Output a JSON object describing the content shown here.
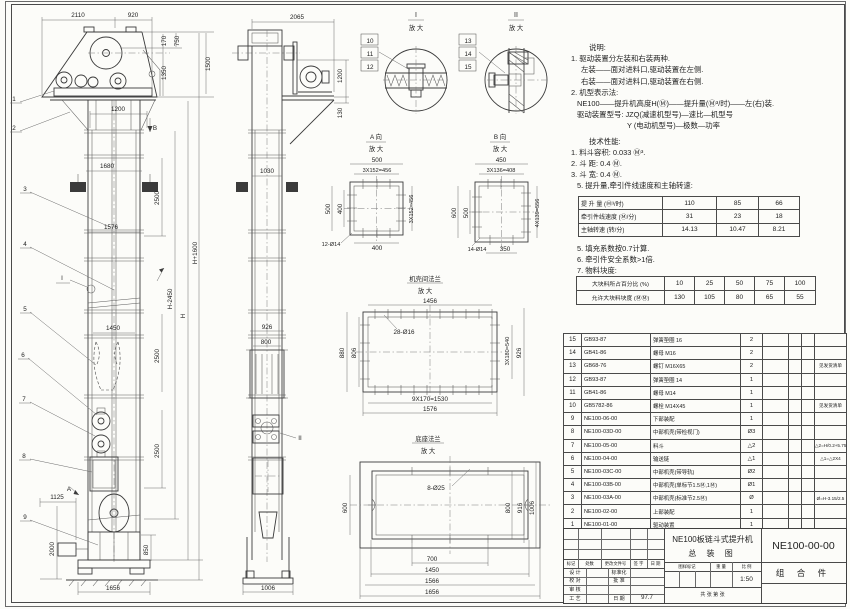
{
  "notes": {
    "lines": [
      {
        "t": "说明:",
        "ind": 26,
        "gap": 0
      },
      {
        "t": "1. 驱动装置分左装和右装两种.",
        "ind": 8,
        "gap": 0
      },
      {
        "t": "左装——面对进料口,驱动装置在左侧.",
        "ind": 18,
        "gap": 0
      },
      {
        "t": "右装——面对进料口,驱动装置在右侧.",
        "ind": 18,
        "gap": 0
      },
      {
        "t": "2. 机型表示法:",
        "ind": 8,
        "gap": 0
      },
      {
        "t": "NE100——提升机高度H(Ⓜ)——提升量(Ⓜ³/时)——左(右)装.",
        "ind": 14,
        "gap": 0
      },
      {
        "t": "驱动装置型号: JZQ(减速机型号)—速比—机型号",
        "ind": 14,
        "gap": 0
      },
      {
        "t": "Y (电动机型号)—极数—功率",
        "ind": 64,
        "gap": 0
      },
      {
        "t": "技术性能:",
        "ind": 26,
        "gap": 4
      },
      {
        "t": "1. 料斗容积: 0.033 Ⓜ³.",
        "ind": 8,
        "gap": 0
      },
      {
        "t": "2. 斗  距: 0.4 Ⓜ.",
        "ind": 8,
        "gap": 0
      },
      {
        "t": "3. 斗  宽: 0.4 Ⓜ.",
        "ind": 8,
        "gap": 0
      },
      {
        "t": "5. 提升量,牵引件线速度和主轴转速:",
        "ind": 14,
        "gap": 0
      }
    ]
  },
  "notes2": {
    "lines": [
      {
        "t": "5. 填充系数按0.7计算.",
        "ind": 14,
        "gap": 0
      },
      {
        "t": "6. 牵引件安全系数>1倍.",
        "ind": 14,
        "gap": 0
      },
      {
        "t": "7. 物料块度:",
        "ind": 14,
        "gap": 0
      }
    ]
  },
  "spec_table1": {
    "rows": [
      [
        "提 升 量  (Ⓜ³/时)",
        "110",
        "85",
        "66"
      ],
      [
        "牵引件线速度 (Ⓜ/分)",
        "31",
        "23",
        "18"
      ],
      [
        "主轴转速  (转/分)",
        "14.13",
        "10.47",
        "8.21"
      ]
    ]
  },
  "lump_table": {
    "rows": [
      [
        "大块料所占百分比 (%)",
        "10",
        "25",
        "50",
        "75",
        "100"
      ],
      [
        "允许大块料块度 (ⓂⓂ)",
        "130",
        "105",
        "80",
        "65",
        "55"
      ]
    ]
  },
  "bom": {
    "rows": [
      [
        "15",
        "GB93-87",
        "弹簧垫圈 16",
        "2",
        "",
        "",
        "",
        ""
      ],
      [
        "14",
        "GB41-86",
        "螺母 M16",
        "2",
        "",
        "",
        "",
        ""
      ],
      [
        "13",
        "GB68-76",
        "螺钉 M16X65",
        "2",
        "",
        "",
        "",
        "见发货清单"
      ],
      [
        "12",
        "GB93-87",
        "弹簧垫圈 14",
        "1",
        "",
        "",
        "",
        ""
      ],
      [
        "11",
        "GB41-86",
        "螺母 M14",
        "1",
        "",
        "",
        "",
        ""
      ],
      [
        "10",
        "GB5782-86",
        "螺栓 M14X45",
        "1",
        "",
        "",
        "",
        "见发货清单"
      ],
      [
        "9",
        "NE100-06-00",
        "下部装配",
        "1",
        "",
        "",
        "",
        ""
      ],
      [
        "8",
        "NE100-03D-00",
        "中部机壳(带检视门)",
        "Ø3",
        "",
        "",
        "",
        ""
      ],
      [
        "7",
        "NE100-05-00",
        "料斗",
        "△2",
        "",
        "",
        "",
        "△2=H/0.2+5.75"
      ],
      [
        "6",
        "NE100-04-00",
        "输送链",
        "△1",
        "",
        "",
        "",
        "△1=△2X4"
      ],
      [
        "5",
        "NE100-03C-00",
        "中部机壳(带导轨)",
        "Ø2",
        "",
        "",
        "",
        ""
      ],
      [
        "4",
        "NE100-03B-00",
        "中部机壳(单标节1.5Ⓜ,1Ⓜ)",
        "Ø1",
        "",
        "",
        "",
        ""
      ],
      [
        "3",
        "NE100-03A-00",
        "中部机壳(标准节2.5Ⓜ)",
        "Ø",
        "",
        "",
        "",
        "Ø=H-3.15/2.5"
      ],
      [
        "2",
        "NE100-02-00",
        "上部装配",
        "1",
        "",
        "",
        "",
        ""
      ],
      [
        "1",
        "NE100-01-00",
        "驱动装置",
        "1",
        "",
        "",
        "",
        ""
      ]
    ],
    "footer": [
      "序号",
      "代  号",
      "名      称",
      "数量",
      "材  料",
      "单重",
      "总重",
      "备  注"
    ]
  },
  "title_block": {
    "product": "NE100板链斗式提升机",
    "title": "总  装  图",
    "dno": "NE100-00-00",
    "part": "组 合 件",
    "scale": "1:50",
    "date": "97.7",
    "rev_headers": [
      "标记",
      "处数",
      "更改文件号",
      "签 字",
      "日 期"
    ],
    "col1": [
      "设 计",
      "校 对",
      "审 核",
      "工 艺"
    ],
    "col2": [
      "标准化",
      "批 准",
      "",
      "日 期"
    ],
    "stamp": [
      "图样标记",
      "重 量",
      "比 例"
    ],
    "pages": "共    张   第    张"
  },
  "drawing": {
    "labels": [
      {
        "t": "2110",
        "x": 78,
        "y": 17
      },
      {
        "t": "920",
        "x": 133,
        "y": 17
      },
      {
        "t": "170",
        "x": 166,
        "y": 41,
        "r": -90
      },
      {
        "t": "750",
        "x": 179,
        "y": 41,
        "r": -90
      },
      {
        "t": "1350",
        "x": 166,
        "y": 73,
        "r": -90
      },
      {
        "t": "1500",
        "x": 210,
        "y": 64,
        "r": -90
      },
      {
        "t": "1200",
        "x": 118,
        "y": 111
      },
      {
        "t": "B",
        "x": 155,
        "y": 130
      },
      {
        "t": "1680",
        "x": 107,
        "y": 168
      },
      {
        "t": "2500",
        "x": 159,
        "y": 198,
        "r": -90
      },
      {
        "t": "1576",
        "x": 111,
        "y": 229
      },
      {
        "t": "H+1600",
        "x": 197,
        "y": 253,
        "r": -90
      },
      {
        "t": "H-2450",
        "x": 172,
        "y": 299,
        "r": -90
      },
      {
        "t": "H",
        "x": 185,
        "y": 316,
        "r": -90
      },
      {
        "t": "1450",
        "x": 113,
        "y": 330
      },
      {
        "t": "2500",
        "x": 159,
        "y": 356,
        "r": -90
      },
      {
        "t": "2500",
        "x": 159,
        "y": 451,
        "r": -90
      },
      {
        "t": "1125",
        "x": 57,
        "y": 499
      },
      {
        "t": "2000",
        "x": 54,
        "y": 549,
        "r": -90
      },
      {
        "t": "850",
        "x": 148,
        "y": 550,
        "r": -90
      },
      {
        "t": "1656",
        "x": 113,
        "y": 590
      },
      {
        "t": "A",
        "x": 69,
        "y": 491
      },
      {
        "t": "I",
        "x": 62,
        "y": 280
      },
      {
        "t": "1",
        "x": 14,
        "y": 101
      },
      {
        "t": "2",
        "x": 14,
        "y": 130
      },
      {
        "t": "3",
        "x": 25,
        "y": 191
      },
      {
        "t": "4",
        "x": 25,
        "y": 246
      },
      {
        "t": "5",
        "x": 25,
        "y": 311
      },
      {
        "t": "6",
        "x": 23,
        "y": 357
      },
      {
        "t": "7",
        "x": 24,
        "y": 401
      },
      {
        "t": "8",
        "x": 24,
        "y": 458
      },
      {
        "t": "9",
        "x": 25,
        "y": 519
      },
      {
        "t": "2065",
        "x": 297,
        "y": 19
      },
      {
        "t": "1200",
        "x": 342,
        "y": 76,
        "r": -90
      },
      {
        "t": "130",
        "x": 342,
        "y": 113,
        "r": -90
      },
      {
        "t": "1030",
        "x": 267,
        "y": 173
      },
      {
        "t": "926",
        "x": 267,
        "y": 329
      },
      {
        "t": "800",
        "x": 266,
        "y": 344
      },
      {
        "t": "1006",
        "x": 268,
        "y": 590
      },
      {
        "t": "II",
        "x": 300,
        "y": 440
      },
      {
        "t": "I",
        "x": 416,
        "y": 17,
        "s": 7
      },
      {
        "t": "放 大",
        "x": 416,
        "y": 30
      },
      {
        "t": "II",
        "x": 516,
        "y": 17,
        "s": 7
      },
      {
        "t": "放 大",
        "x": 516,
        "y": 30
      },
      {
        "t": "10",
        "x": 370,
        "y": 43
      },
      {
        "t": "11",
        "x": 370,
        "y": 56
      },
      {
        "t": "12",
        "x": 370,
        "y": 69
      },
      {
        "t": "13",
        "x": 468,
        "y": 43
      },
      {
        "t": "14",
        "x": 468,
        "y": 56
      },
      {
        "t": "15",
        "x": 468,
        "y": 69
      },
      {
        "t": "A 向",
        "x": 376,
        "y": 139
      },
      {
        "t": "放 大",
        "x": 376,
        "y": 151
      },
      {
        "t": "500",
        "x": 377,
        "y": 162
      },
      {
        "t": "3X152=456",
        "x": 377,
        "y": 172,
        "s": 5.6
      },
      {
        "t": "500",
        "x": 330,
        "y": 209,
        "r": -90
      },
      {
        "t": "400",
        "x": 342,
        "y": 209,
        "r": -90
      },
      {
        "t": "3X152=456",
        "x": 413,
        "y": 209,
        "r": -90,
        "s": 5.6
      },
      {
        "t": "400",
        "x": 377,
        "y": 250
      },
      {
        "t": "12-Ø14",
        "x": 331,
        "y": 246,
        "s": 5.6
      },
      {
        "t": "B 向",
        "x": 500,
        "y": 139
      },
      {
        "t": "放 大",
        "x": 500,
        "y": 151
      },
      {
        "t": "450",
        "x": 501,
        "y": 162
      },
      {
        "t": "3X136=408",
        "x": 501,
        "y": 172,
        "s": 5.6
      },
      {
        "t": "600",
        "x": 456,
        "y": 213,
        "r": -90
      },
      {
        "t": "500",
        "x": 468,
        "y": 213,
        "r": -90
      },
      {
        "t": "4X139=556",
        "x": 539,
        "y": 213,
        "r": -90,
        "s": 5.6
      },
      {
        "t": "350",
        "x": 505,
        "y": 251
      },
      {
        "t": "14-Ø14",
        "x": 477,
        "y": 251,
        "s": 5.6
      },
      {
        "t": "机壳间法兰",
        "x": 425,
        "y": 281
      },
      {
        "t": "放 大",
        "x": 425,
        "y": 293
      },
      {
        "t": "1456",
        "x": 430,
        "y": 303
      },
      {
        "t": "28-Ø16",
        "x": 404,
        "y": 334
      },
      {
        "t": "880",
        "x": 344,
        "y": 353,
        "r": -90
      },
      {
        "t": "806",
        "x": 356,
        "y": 353,
        "r": -90
      },
      {
        "t": "3X180=540",
        "x": 509,
        "y": 351,
        "r": -90,
        "s": 5.6
      },
      {
        "t": "926",
        "x": 521,
        "y": 353,
        "r": -90
      },
      {
        "t": "9X170=1530",
        "x": 430,
        "y": 401
      },
      {
        "t": "1576",
        "x": 430,
        "y": 411
      },
      {
        "t": "底座法兰",
        "x": 428,
        "y": 441
      },
      {
        "t": "放 大",
        "x": 428,
        "y": 453
      },
      {
        "t": "8-Ø25",
        "x": 436,
        "y": 490
      },
      {
        "t": "600",
        "x": 347,
        "y": 508,
        "r": -90
      },
      {
        "t": "800",
        "x": 510,
        "y": 508,
        "r": -90
      },
      {
        "t": "916",
        "x": 522,
        "y": 508,
        "r": -90
      },
      {
        "t": "1006",
        "x": 534,
        "y": 508,
        "r": -90
      },
      {
        "t": "700",
        "x": 432,
        "y": 561
      },
      {
        "t": "1450",
        "x": 432,
        "y": 572
      },
      {
        "t": "1566",
        "x": 432,
        "y": 583
      },
      {
        "t": "1656",
        "x": 432,
        "y": 594
      }
    ]
  }
}
